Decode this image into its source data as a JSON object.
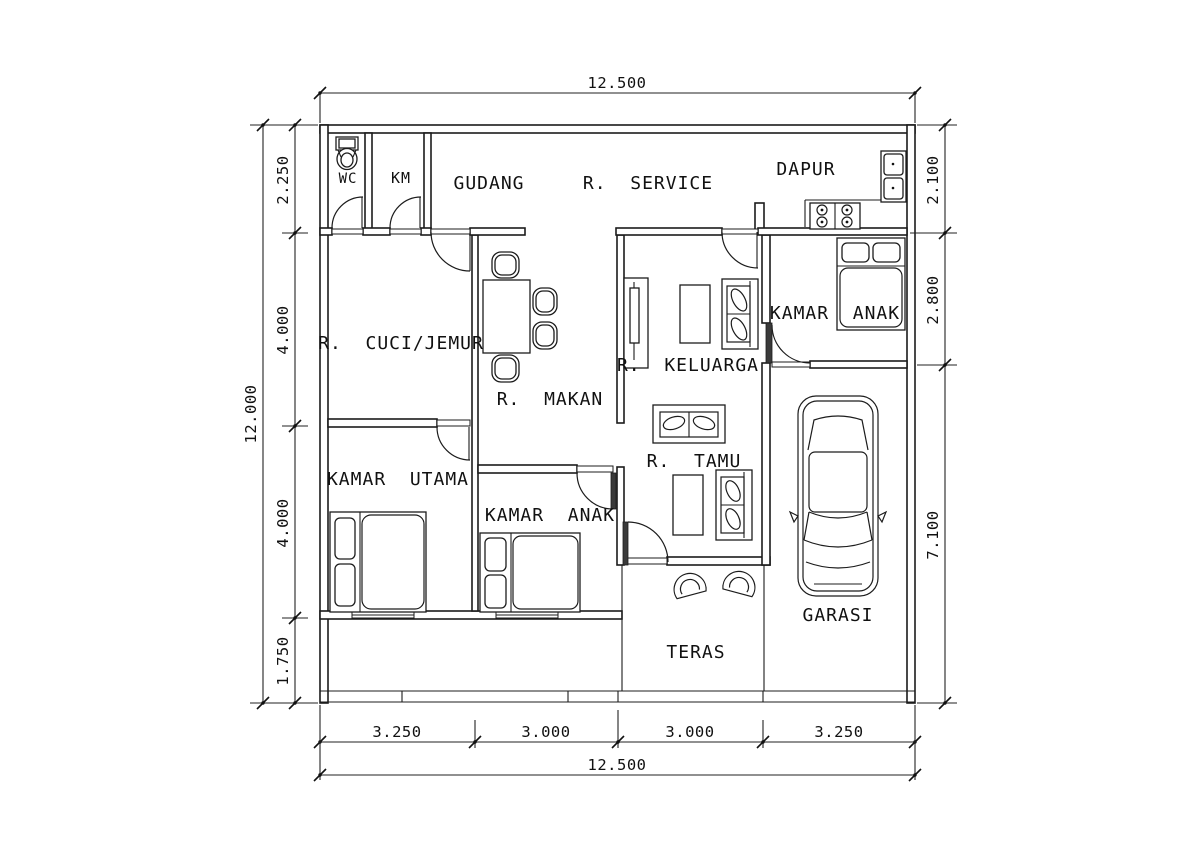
{
  "drawing": {
    "colors": {
      "line": "#1c1c1c",
      "background": "#ffffff"
    },
    "rooms": {
      "wc": {
        "label": "WC"
      },
      "km": {
        "label": "KM"
      },
      "gudang": {
        "label": "GUDANG"
      },
      "service": {
        "label": "R.  SERVICE"
      },
      "dapur": {
        "label": "DAPUR"
      },
      "kamar_anak_atas": {
        "label": "KAMAR  ANAK"
      },
      "cuci_jemur": {
        "label": "R.  CUCI/JEMUR"
      },
      "makan": {
        "label": "R.  MAKAN"
      },
      "keluarga": {
        "label": "R.  KELUARGA"
      },
      "kamar_utama": {
        "label": "KAMAR  UTAMA"
      },
      "kamar_anak_bawah": {
        "label": "KAMAR  ANAK"
      },
      "tamu": {
        "label": "R.  TAMU"
      },
      "garasi": {
        "label": "GARASI"
      },
      "teras": {
        "label": "TERAS"
      }
    },
    "dimensions": {
      "top_total": "12.500",
      "bottom_total": "12.500",
      "bottom_segments": [
        "3.250",
        "3.000",
        "3.000",
        "3.250"
      ],
      "left_total": "12.000",
      "left_segments": [
        "2.250",
        "4.000",
        "4.000",
        "1.750"
      ],
      "right_segments": [
        "2.100",
        "2.800",
        "7.100"
      ]
    }
  }
}
